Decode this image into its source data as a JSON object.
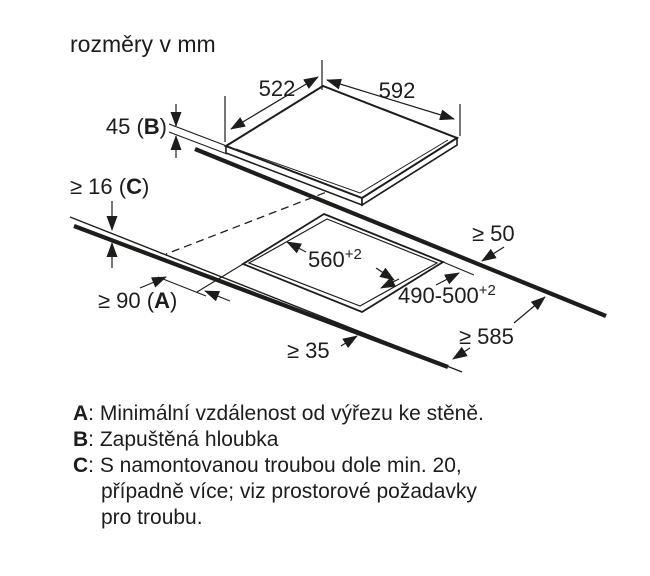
{
  "title": "rozměry v mm",
  "diagram": {
    "dims": {
      "top_width": "592",
      "top_depth": "522",
      "build_in_depth": {
        "pre": "45 (",
        "letter": "B",
        "post": ")"
      },
      "worktop_thickness": {
        "pre": "≥ 16 (",
        "letter": "C",
        "post": ")"
      },
      "rear_clearance": "≥ 50",
      "cutout_width": {
        "base": "560",
        "sup": "+2"
      },
      "cutout_depth": {
        "base": "490-500",
        "sup": "+2"
      },
      "wall_clearance": {
        "pre": "≥ 90 (",
        "letter": "A",
        "post": ")"
      },
      "front_clearance": "≥ 35",
      "worktop_depth": "≥ 585"
    }
  },
  "legend": {
    "items": [
      {
        "letter": "A",
        "text": ": Minimální vzdálenost od výřezu ke stěně."
      },
      {
        "letter": "B",
        "text": ": Zapuštěná hloubka"
      },
      {
        "letter": "C",
        "text": ": S namontovanou troubou dole min. 20,"
      },
      {
        "letter": "",
        "text": "případně více; viz prostorové požadavky"
      },
      {
        "letter": "",
        "text": "pro troubu."
      }
    ]
  },
  "colors": {
    "ink": "#1d1d1b",
    "background": "#ffffff"
  }
}
